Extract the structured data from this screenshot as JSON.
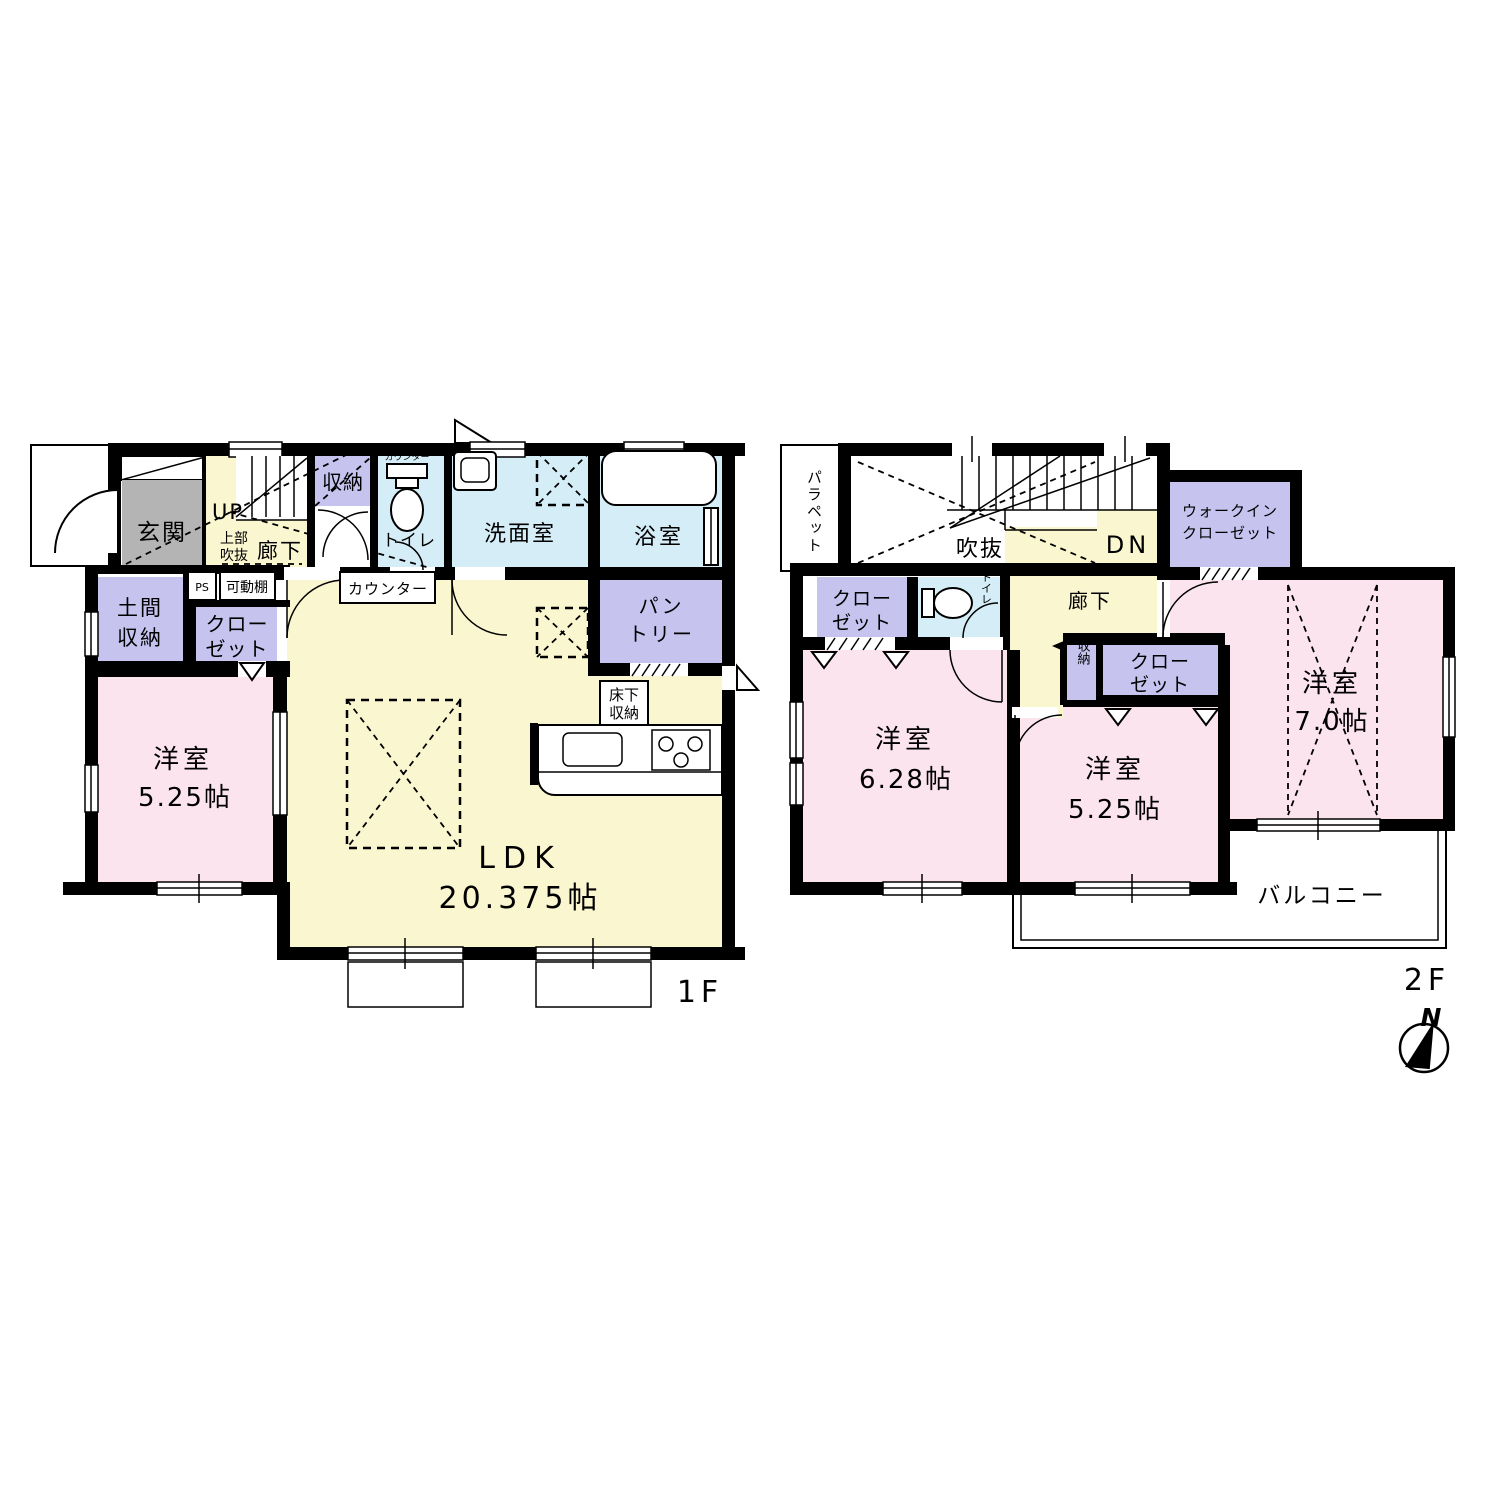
{
  "colors": {
    "wall": "#000000",
    "hall_cream": "#FAF6D0",
    "room_pink": "#FBE4EE",
    "closet_purple": "#C6C3EF",
    "wet_blue": "#D5EDF7",
    "genkan_gray": "#B4B4B4",
    "white": "#FFFFFF"
  },
  "floor1": {
    "floor_label": "1F",
    "genkan": "玄関",
    "up": "UP",
    "joubu_fukinuke": [
      "上部",
      "吹抜"
    ],
    "rouka": "廊下",
    "shuunou": "収納",
    "counter_top": "カウンター",
    "toilet": "トイレ",
    "senmenshitsu": "洗面室",
    "yokushitsu": "浴室",
    "pantry": [
      "パン",
      "トリー"
    ],
    "counter_mid": "カウンター",
    "ps": "PS",
    "kadoudana": "可動棚",
    "doma_shuunou": [
      "土間",
      "収納"
    ],
    "closet": [
      "クロー",
      "ゼット"
    ],
    "youshitsu_525": [
      "洋室",
      "5.25帖"
    ],
    "ldk": [
      "LDK",
      "20.375帖"
    ],
    "yukashita_shuunou": [
      "床下",
      "収納"
    ]
  },
  "floor2": {
    "floor_label": "2F",
    "parapet": "パラペット",
    "fukinuke": "吹抜",
    "dn": "DN",
    "walkin_closet": [
      "ウォークイン",
      "クローゼット"
    ],
    "closet_left": [
      "クロー",
      "ゼット"
    ],
    "toilet": "トイレ",
    "rouka": "廊下",
    "shuunou": "収納",
    "closet_mid": [
      "クロー",
      "ゼット"
    ],
    "youshitsu_628": [
      "洋室",
      "6.28帖"
    ],
    "youshitsu_525": [
      "洋室",
      "5.25帖"
    ],
    "youshitsu_70": [
      "洋室",
      "7.0帖"
    ],
    "balcony": "バルコニー"
  },
  "compass": {
    "north": "N"
  }
}
